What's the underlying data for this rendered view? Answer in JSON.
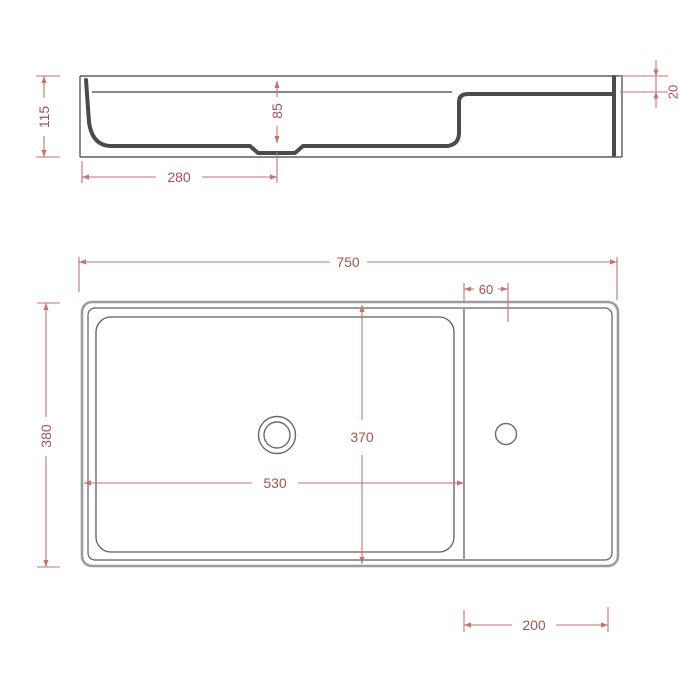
{
  "drawing": {
    "dims": {
      "side": {
        "overall_height": "115",
        "basin_depth": "85",
        "drain_offset": "280",
        "deck_recess": "20"
      },
      "plan": {
        "overall_width": "750",
        "tap_hole_offset": "60",
        "overall_depth": "380",
        "inner_depth": "370",
        "basin_width": "530",
        "deck_width": "200"
      }
    },
    "colors": {
      "dimension_red": "#b0554f",
      "line_dark": "#3f3f3f",
      "shadow_gray": "#9c9c9c",
      "background": "#ffffff"
    }
  }
}
